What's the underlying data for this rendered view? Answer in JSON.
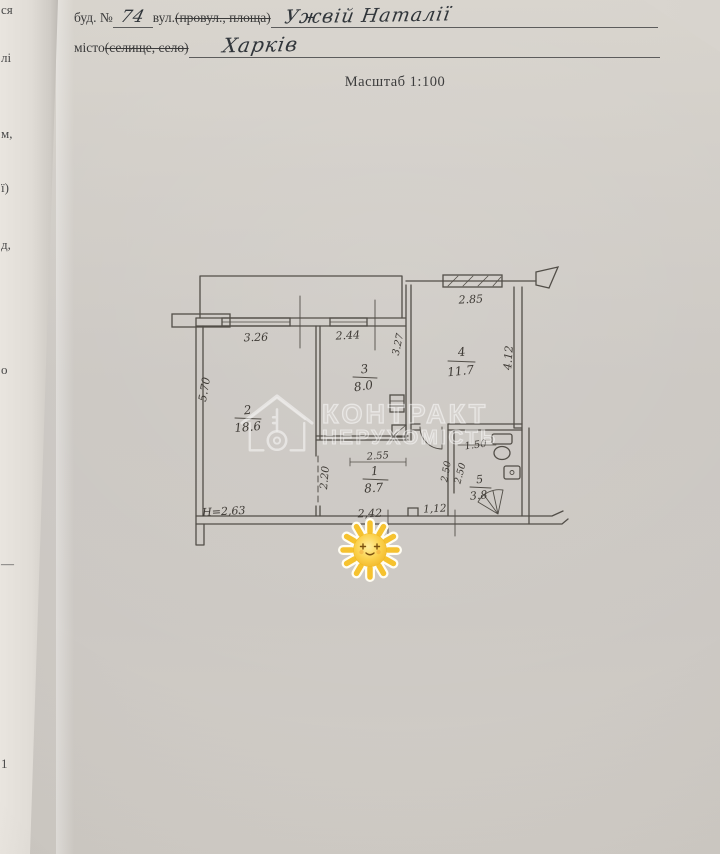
{
  "form": {
    "building_label": "буд. №",
    "building_number": "74",
    "street_label": "вул.",
    "street_label_struck": "(провул., площа)",
    "street_value": "Ужвій Наталії",
    "city_label": "місто",
    "city_label_struck": "(селище, село)",
    "city_value": "Харків",
    "scale": "Масштаб 1:100"
  },
  "watermark": {
    "line1": "КОНТРАКТ",
    "line2": "НЕРУХОМІСТЬ"
  },
  "plan": {
    "rooms": [
      {
        "number": "1",
        "area": "8.7"
      },
      {
        "number": "2",
        "area": "18.6"
      },
      {
        "number": "3",
        "area": "8.0"
      },
      {
        "number": "4",
        "area": "11.7"
      },
      {
        "number": "5",
        "area": "3.8"
      }
    ],
    "dims": {
      "win_left": "3.26",
      "win_mid": "2.44",
      "balcony": "2.85",
      "room3_depth": "3.27",
      "room4_depth": "4.12",
      "room2_depth": "5.70",
      "hall_top": "2.55",
      "hall_left": "2.20",
      "wc_width": "1.50",
      "wc_depth": "2.50",
      "wc_depth2": "2.50",
      "height": "Н=2,63",
      "bottom_mid": "2,42",
      "bottom_right": "1,12"
    }
  },
  "page_fragments": [
    {
      "t": "ся"
    },
    {
      "t": "лі"
    },
    {
      "t": "м,"
    },
    {
      "t": "ї)"
    },
    {
      "t": "д,"
    },
    {
      "t": "о"
    },
    {
      "t": "—"
    },
    {
      "t": "1"
    }
  ]
}
